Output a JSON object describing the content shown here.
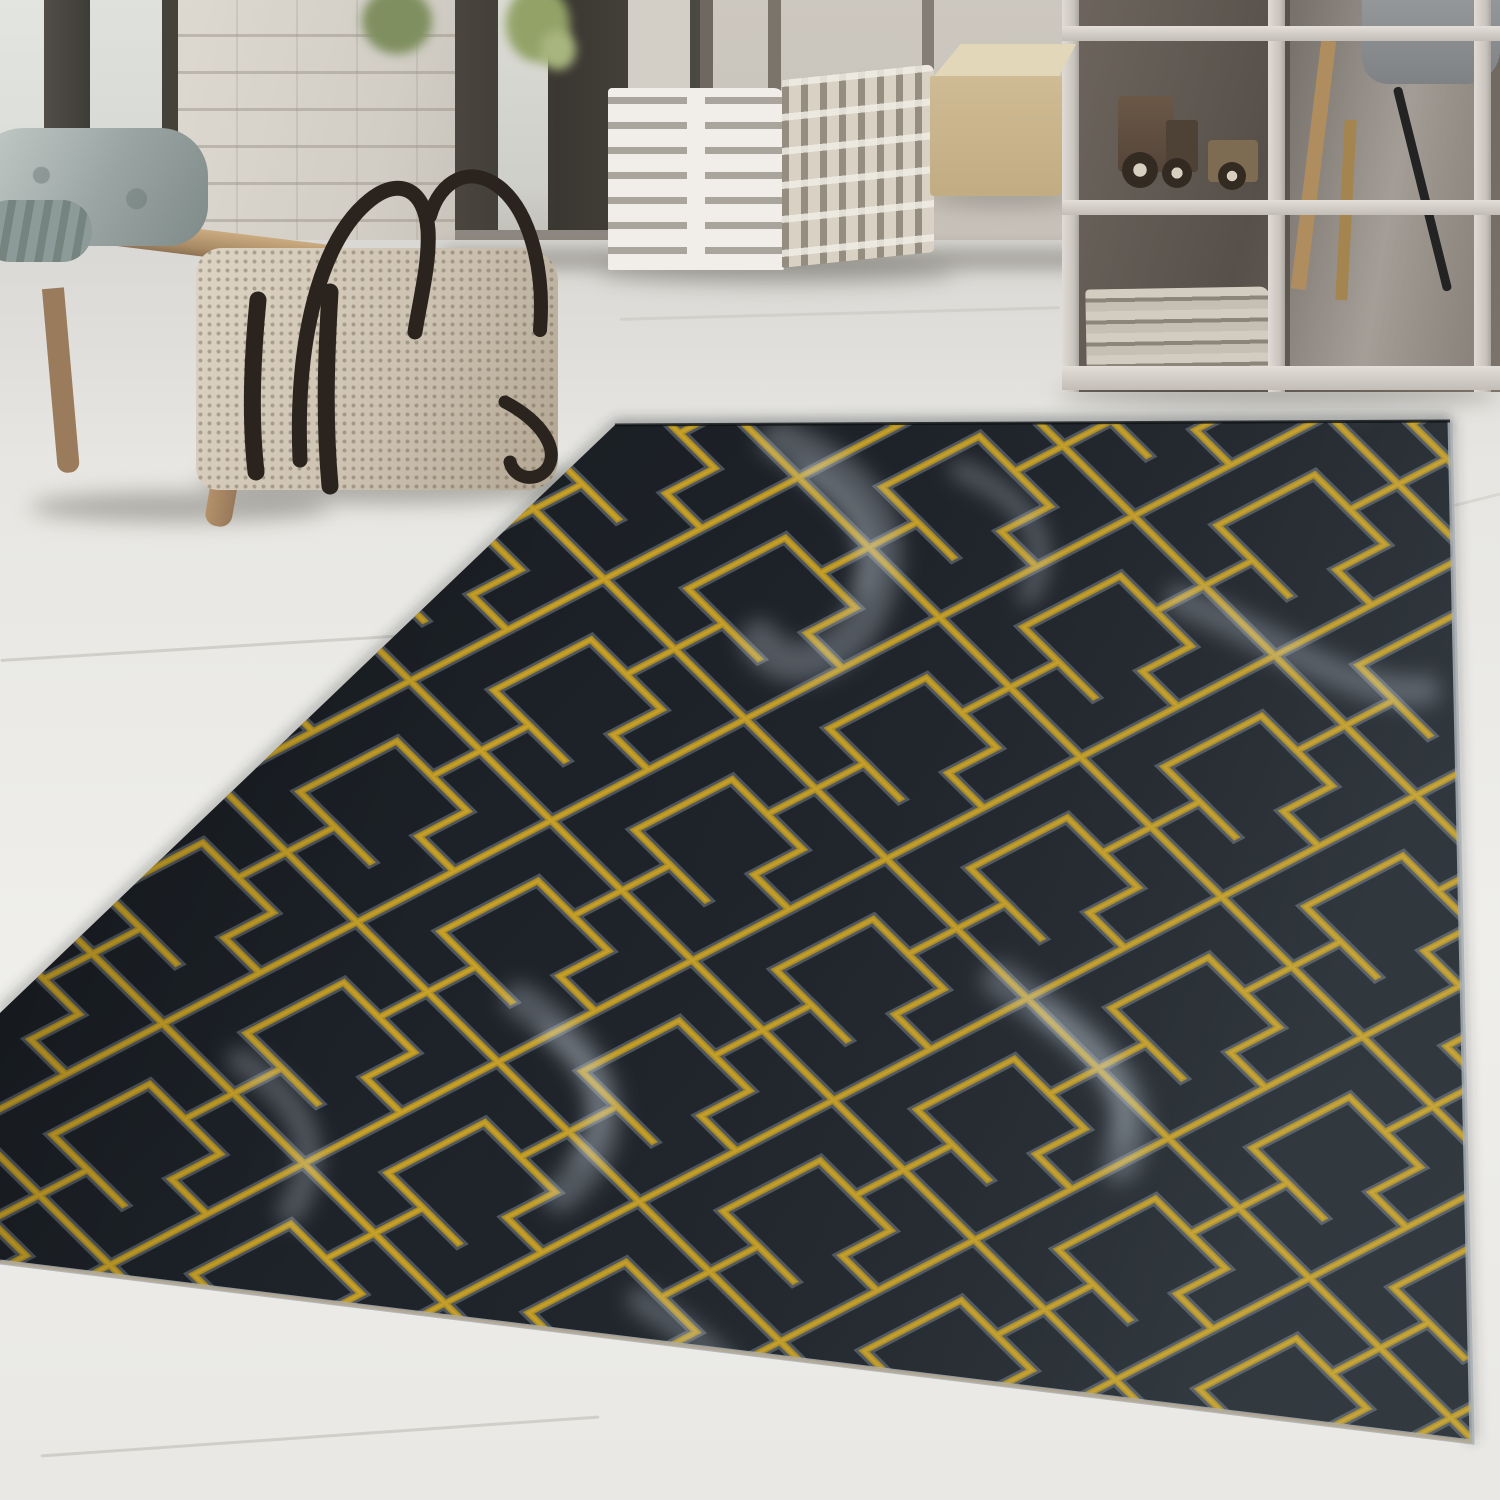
{
  "scene": {
    "description": "Photograph of a dark charcoal-black rug with a gold Art-Deco maze pattern and white marble veining, lying on a whitewashed wood floor in a bright modern interior",
    "objects": [
      {
        "name": "rug",
        "style": "black marbled pile with gold geometric maze lines and gray fringing"
      },
      {
        "name": "wood-floor",
        "style": "whitewashed planks"
      },
      {
        "name": "window-wall",
        "style": "dark framed glass doors"
      },
      {
        "name": "white-brick-wall"
      },
      {
        "name": "wooden-bench",
        "with": [
          "gray-cushion",
          "rolled-blanket"
        ]
      },
      {
        "name": "knitted-duffel-bag",
        "style": "cream woven fabric with dark leather straps"
      },
      {
        "name": "striped-cube-pouf",
        "style": "white with gray dashes"
      },
      {
        "name": "beige-leather-cube"
      },
      {
        "name": "white-grid-shelf",
        "contents": [
          "wooden-toy-truck",
          "newspaper-stack"
        ]
      },
      {
        "name": "gray-chair",
        "detail": "wooden and black legs visible behind shelf"
      },
      {
        "name": "plant-leaves"
      }
    ]
  },
  "palette": {
    "floor": "#e7e6e2",
    "floor_light": "#efeeea",
    "wall_light": "#cfcac2",
    "wall_dark": "#3e3c37",
    "brick": "#d6d2ca",
    "wood": "#b4916b",
    "cushion": "#9aa5a3",
    "bag": "#cdc2b1",
    "bag_strap": "#2b241e",
    "pouf_light": "#f1eee9",
    "pouf_stripe": "#a9a49c",
    "cube_beige": "#c9b48c",
    "shelf_frame": "#d5d0c9",
    "shelf_backdrop": "#57504a",
    "rug_base_dark": "#14171b",
    "rug_base_mid": "#1d2228",
    "rug_base_light": "#242b31",
    "rug_gold": "#b3901f",
    "rug_gold_bright": "#caa52c",
    "rug_fringe_gray": "#7f8a96",
    "rug_vein": "#cfdbe4",
    "rug_edge": "#a8afb4",
    "rug_backing": "#b5a88f",
    "shadow": "#696660"
  }
}
